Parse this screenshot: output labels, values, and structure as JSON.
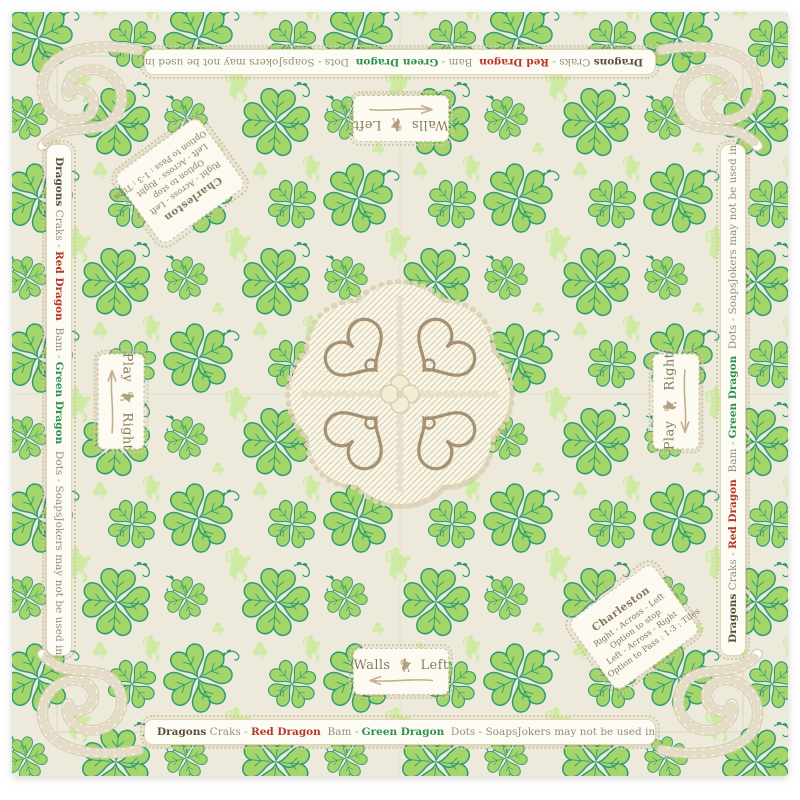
{
  "mat": {
    "background": "#edeadb",
    "pattern_colors": {
      "clover_fill": "#a3d56b",
      "clover_outline": "#2e9a74",
      "pale_accent": "#cdeba3",
      "rope": "#ffffff",
      "lace_tan": "#a59173"
    }
  },
  "suit_legend": {
    "dragons_label": "Dragons",
    "craks_label": " Craks - ",
    "red_dragon_label": "Red Dragon",
    "bam_label": "  Bam - ",
    "green_dragon_label": "Green Dragon",
    "dots_label": "  Dots - Soaps",
    "jokers_rule": "Jokers may not be used in singles or pairs",
    "red_color": "#b5372a",
    "green_color": "#2e8f52"
  },
  "walls_card": {
    "prefix": "Walls",
    "suffix": "Left",
    "arrow_icon": "long-left-arrow",
    "divider_icon": "lion-rampant"
  },
  "play_card": {
    "prefix": "Play",
    "suffix": "Right",
    "arrow_icon": "long-left-arrow",
    "divider_icon": "lion-rampant"
  },
  "charleston_card": {
    "title": "Charleston",
    "lines": [
      "Right - Across - Left",
      "Option to stop",
      "Left - Across - Right",
      "Option to Pass : 1-3 : Tiles"
    ]
  }
}
